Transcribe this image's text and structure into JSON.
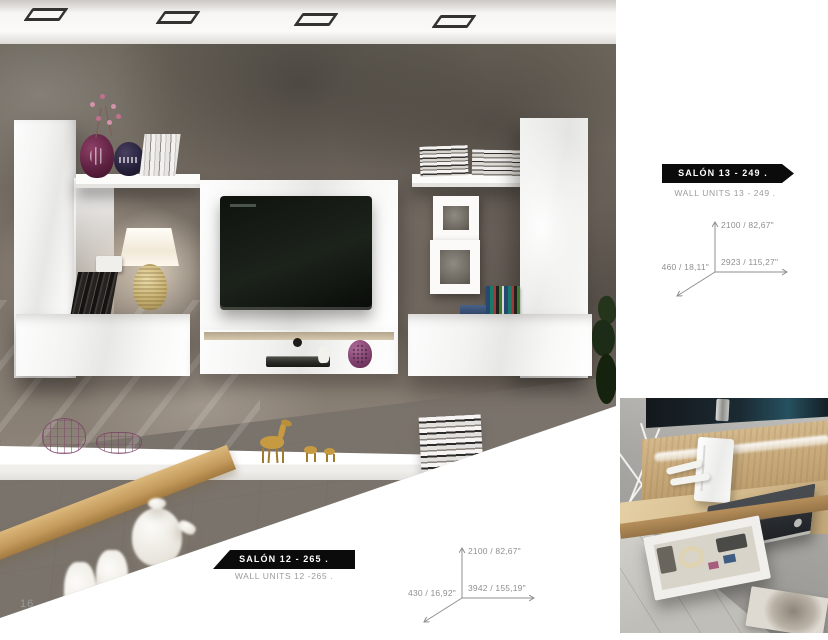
{
  "page": {
    "number": "16"
  },
  "products": [
    {
      "name": "SALÓN 13 - 249 .",
      "subtitle": "WALL UNITS 13 - 249 .",
      "dimensions": {
        "height": "2100 / 82,67\"",
        "width": "2923 / 115,27\"",
        "depth": "460 / 18,11\""
      }
    },
    {
      "name": "SALÓN 12 - 265 .",
      "subtitle": "WALL UNITS 12 -265 .",
      "dimensions": {
        "height": "2100 / 82,67\"",
        "width": "3942 / 155,19\"",
        "depth": "430 / 16,92\""
      }
    }
  ],
  "photos": [
    {
      "label": "modern living room with white high-gloss wall units, TV and lamp"
    },
    {
      "label": "detail of oak media shelf with open drawer and DVD player"
    }
  ],
  "colors": {
    "banner_bg": "#0b0b0b",
    "banner_text": "#ffffff",
    "subtitle_text": "#9b9b9b",
    "dimension_text": "#8f8f8f",
    "page_number": "#9a9a9a"
  }
}
